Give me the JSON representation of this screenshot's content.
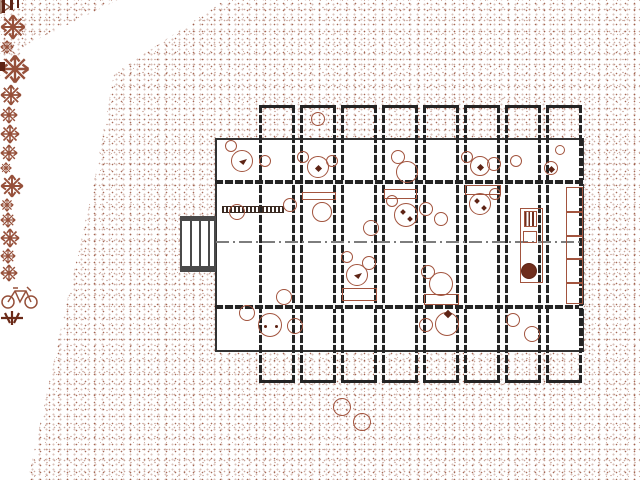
{
  "meta": {
    "view": "architectural-site-plan",
    "canvas": {
      "w": 640,
      "h": 480
    },
    "visible_text": []
  },
  "colors": {
    "wall_dark": "#242424",
    "slab_outline": "#333333",
    "furniture_brown": "#a2543e",
    "glyph_maroon": "#5e2415",
    "stipple_brown": "#96503a",
    "centerline_gray": "#7d7d7d",
    "deck_gray": "#4a4a4a"
  },
  "building": {
    "slab": {
      "x": 215,
      "y": 138,
      "w": 369,
      "h": 214
    },
    "bay_xs": [
      259,
      300,
      341,
      382,
      423,
      464,
      505,
      546
    ],
    "bay": {
      "w": 36,
      "wall_w": 3,
      "top": 105,
      "h": 278
    },
    "hwalls": [
      {
        "x": 215,
        "y": 180,
        "w": 369
      },
      {
        "x": 215,
        "y": 305,
        "w": 369
      }
    ],
    "right_wall": {
      "x": 579,
      "y": 138,
      "h": 214
    },
    "centerline": {
      "x": 216,
      "y": 241,
      "w": 366
    }
  },
  "furniture": {
    "circles": [
      {
        "cx": 231,
        "cy": 146,
        "r": 6
      },
      {
        "cx": 242,
        "cy": 161,
        "r": 11,
        "deco": "bird"
      },
      {
        "cx": 265,
        "cy": 161,
        "r": 6
      },
      {
        "cx": 303,
        "cy": 157,
        "r": 6
      },
      {
        "cx": 318,
        "cy": 167,
        "r": 11,
        "deco": "glyph"
      },
      {
        "cx": 332,
        "cy": 161,
        "r": 6
      },
      {
        "cx": 398,
        "cy": 157,
        "r": 7
      },
      {
        "cx": 407,
        "cy": 172,
        "r": 11
      },
      {
        "cx": 467,
        "cy": 157,
        "r": 6
      },
      {
        "cx": 480,
        "cy": 166,
        "r": 10,
        "deco": "glyph"
      },
      {
        "cx": 494,
        "cy": 164,
        "r": 7
      },
      {
        "cx": 516,
        "cy": 161,
        "r": 6
      },
      {
        "cx": 551,
        "cy": 168,
        "r": 7,
        "deco": "glyph"
      },
      {
        "cx": 560,
        "cy": 150,
        "r": 5
      },
      {
        "cx": 318,
        "cy": 119,
        "r": 7
      },
      {
        "cx": 237,
        "cy": 212,
        "r": 8
      },
      {
        "cx": 290,
        "cy": 205,
        "r": 7
      },
      {
        "cx": 322,
        "cy": 212,
        "r": 10
      },
      {
        "cx": 371,
        "cy": 228,
        "r": 8
      },
      {
        "cx": 392,
        "cy": 201,
        "r": 6
      },
      {
        "cx": 406,
        "cy": 215,
        "r": 12,
        "deco": "glyph2"
      },
      {
        "cx": 426,
        "cy": 209,
        "r": 7
      },
      {
        "cx": 441,
        "cy": 219,
        "r": 7
      },
      {
        "cx": 480,
        "cy": 204,
        "r": 11,
        "deco": "glyph2"
      },
      {
        "cx": 495,
        "cy": 194,
        "r": 6
      },
      {
        "cx": 347,
        "cy": 257,
        "r": 6
      },
      {
        "cx": 369,
        "cy": 263,
        "r": 7
      },
      {
        "cx": 357,
        "cy": 275,
        "r": 11,
        "deco": "bird"
      },
      {
        "cx": 428,
        "cy": 272,
        "r": 7
      },
      {
        "cx": 441,
        "cy": 284,
        "r": 12
      },
      {
        "cx": 284,
        "cy": 297,
        "r": 8
      },
      {
        "cx": 247,
        "cy": 313,
        "r": 8
      },
      {
        "cx": 270,
        "cy": 325,
        "r": 12,
        "deco": "dots2"
      },
      {
        "cx": 295,
        "cy": 326,
        "r": 8
      },
      {
        "cx": 426,
        "cy": 325,
        "r": 7
      },
      {
        "cx": 447,
        "cy": 324,
        "r": 12,
        "deco": "glyphtop"
      },
      {
        "cx": 513,
        "cy": 320,
        "r": 7
      },
      {
        "cx": 532,
        "cy": 334,
        "r": 8
      }
    ],
    "rects": [
      {
        "x": 302,
        "y": 192,
        "w": 34,
        "h": 8
      },
      {
        "x": 384,
        "y": 189,
        "w": 33,
        "h": 10
      },
      {
        "x": 465,
        "y": 185,
        "w": 36,
        "h": 10
      },
      {
        "x": 342,
        "y": 288,
        "w": 35,
        "h": 13
      },
      {
        "x": 424,
        "y": 294,
        "w": 35,
        "h": 11
      }
    ]
  },
  "fixtures": {
    "bench": {
      "x": 222,
      "y": 206,
      "w": 62,
      "h": 7
    },
    "deck": {
      "x": 180,
      "y": 216,
      "w": 36,
      "h": 56,
      "planks": [
        8,
        17,
        26
      ]
    },
    "triangle": {
      "x": 164,
      "y": 233,
      "w": 11,
      "h": 14
    },
    "shelf": {
      "x": 566,
      "y": 187,
      "w": 17,
      "h": 117,
      "cells": 5
    },
    "kitchen": {
      "counter": {
        "x": 520,
        "y": 208,
        "w": 23,
        "h": 75
      },
      "stove": {
        "x": 524,
        "y": 211,
        "w": 13,
        "h": 16
      },
      "sink": {
        "x": 523,
        "y": 231,
        "w": 14,
        "h": 12
      },
      "bun": {
        "cx": 529,
        "cy": 271,
        "r": 8
      }
    }
  },
  "site": {
    "vegetation": [
      {
        "x": 38,
        "y": 46,
        "s": 26
      },
      {
        "x": 58,
        "y": 64,
        "s": 14
      },
      {
        "x": 158,
        "y": 160,
        "s": 30
      },
      {
        "x": 220,
        "y": 44,
        "s": 22
      },
      {
        "x": 418,
        "y": 30,
        "s": 18
      },
      {
        "x": 512,
        "y": 48,
        "s": 20
      },
      {
        "x": 600,
        "y": 28,
        "s": 18
      },
      {
        "x": 620,
        "y": 4,
        "s": 12
      },
      {
        "x": 208,
        "y": 364,
        "s": 24
      },
      {
        "x": 238,
        "y": 418,
        "s": 14
      },
      {
        "x": 383,
        "y": 458,
        "s": 16
      },
      {
        "x": 520,
        "y": 406,
        "s": 20
      },
      {
        "x": 550,
        "y": 402,
        "s": 16
      },
      {
        "x": 600,
        "y": 456,
        "s": 18
      }
    ],
    "bushes": [
      {
        "cx": 342,
        "cy": 407,
        "r": 9
      },
      {
        "cx": 362,
        "cy": 422,
        "r": 9
      }
    ],
    "bicycle": {
      "x": 128,
      "y": 384,
      "w": 40,
      "h": 28
    },
    "cross_plant": {
      "x": 236,
      "y": 346,
      "w": 24,
      "h": 16
    },
    "corner_marks": [
      {
        "x": 2,
        "y": 0,
        "w": 3,
        "h": 13
      },
      {
        "x": 10,
        "y": 0,
        "w": 3,
        "h": 10
      },
      {
        "x": 17,
        "y": 0,
        "w": 2,
        "h": 8
      },
      {
        "x": 0,
        "y": 62,
        "w": 5,
        "h": 9
      }
    ]
  }
}
